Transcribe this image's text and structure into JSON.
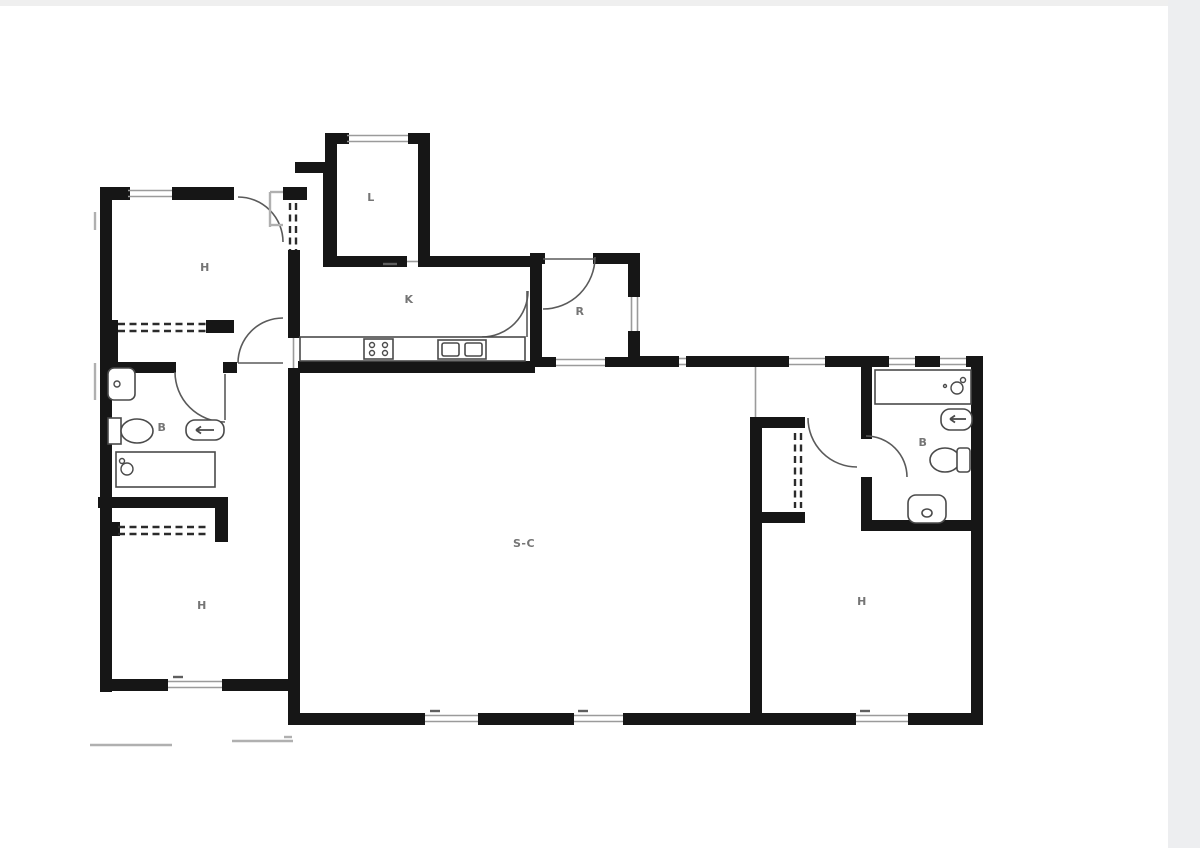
{
  "page": {
    "background": "#ffffff",
    "top_strip_color": "#efefef",
    "right_band_color": "#edeef0"
  },
  "plan": {
    "wall_color": "#161616",
    "window_color": "#9b9b9b",
    "door_color": "#5a5a5a",
    "dash_color": "#2b2b2b",
    "fixture_color": "#4a4a4a",
    "label_color": "#757575",
    "thin_color": "#b0b0b0",
    "tick_color": "#5f5f5f",
    "walls": [
      [
        100,
        187,
        30,
        13
      ],
      [
        172,
        187,
        62,
        13
      ],
      [
        283,
        187,
        24,
        13
      ],
      [
        100,
        187,
        12,
        505
      ],
      [
        106,
        320,
        12,
        45
      ],
      [
        206,
        320,
        28,
        13
      ],
      [
        288,
        250,
        12,
        88
      ],
      [
        288,
        368,
        12,
        357
      ],
      [
        325,
        133,
        12,
        42
      ],
      [
        295,
        162,
        42,
        11
      ],
      [
        323,
        173,
        14,
        94
      ],
      [
        325,
        133,
        24,
        11
      ],
      [
        408,
        133,
        22,
        11
      ],
      [
        418,
        133,
        12,
        134
      ],
      [
        337,
        256,
        70,
        11
      ],
      [
        430,
        256,
        105,
        11
      ],
      [
        530,
        253,
        12,
        114
      ],
      [
        535,
        253,
        10,
        11
      ],
      [
        593,
        253,
        47,
        11
      ],
      [
        628,
        253,
        12,
        44
      ],
      [
        628,
        331,
        12,
        36
      ],
      [
        530,
        357,
        26,
        10
      ],
      [
        605,
        357,
        35,
        10
      ],
      [
        298,
        361,
        237,
        12
      ],
      [
        640,
        356,
        39,
        11
      ],
      [
        686,
        356,
        69,
        11
      ],
      [
        755,
        356,
        34,
        11
      ],
      [
        825,
        356,
        38,
        11
      ],
      [
        863,
        356,
        26,
        11
      ],
      [
        915,
        356,
        25,
        11
      ],
      [
        966,
        356,
        17,
        11
      ],
      [
        971,
        356,
        12,
        368
      ],
      [
        750,
        417,
        12,
        308
      ],
      [
        750,
        417,
        55,
        11
      ],
      [
        758,
        512,
        47,
        11
      ],
      [
        861,
        367,
        11,
        72
      ],
      [
        861,
        477,
        11,
        54
      ],
      [
        861,
        520,
        122,
        11
      ],
      [
        750,
        713,
        106,
        12
      ],
      [
        908,
        713,
        75,
        12
      ],
      [
        288,
        713,
        137,
        12
      ],
      [
        478,
        713,
        96,
        12
      ],
      [
        623,
        713,
        127,
        12
      ],
      [
        100,
        362,
        76,
        11
      ],
      [
        223,
        362,
        14,
        11
      ],
      [
        98,
        497,
        130,
        11
      ],
      [
        215,
        497,
        13,
        45
      ],
      [
        112,
        522,
        8,
        14
      ],
      [
        100,
        679,
        68,
        12
      ],
      [
        222,
        679,
        78,
        12
      ]
    ],
    "windows": [
      {
        "o": "h",
        "x": 128,
        "y": 189,
        "len": 44
      },
      {
        "o": "h",
        "x": 347,
        "y": 134,
        "len": 61
      },
      {
        "o": "v",
        "x": 630,
        "y": 297,
        "len": 34
      },
      {
        "o": "h",
        "x": 556,
        "y": 358,
        "len": 49
      },
      {
        "o": "h",
        "x": 789,
        "y": 357,
        "len": 36
      },
      {
        "o": "h",
        "x": 889,
        "y": 357,
        "len": 26
      },
      {
        "o": "h",
        "x": 940,
        "y": 357,
        "len": 26
      },
      {
        "o": "h",
        "x": 425,
        "y": 714,
        "len": 53
      },
      {
        "o": "h",
        "x": 574,
        "y": 714,
        "len": 49
      },
      {
        "o": "h",
        "x": 856,
        "y": 714,
        "len": 52
      },
      {
        "o": "h",
        "x": 168,
        "y": 680,
        "len": 54
      },
      {
        "o": "h",
        "x": 679,
        "y": 357,
        "len": 7
      },
      {
        "o": "v",
        "x": 292,
        "y": 338,
        "len": 30,
        "single": true
      },
      {
        "o": "v",
        "x": 754,
        "y": 367,
        "len": 50,
        "single": true
      },
      {
        "o": "h",
        "x": 407,
        "y": 260,
        "len": 11,
        "single": true
      }
    ],
    "dashes": [
      [
        290,
        203,
        290,
        250
      ],
      [
        296,
        203,
        296,
        250
      ],
      [
        118,
        324,
        206,
        324
      ],
      [
        118,
        331,
        206,
        331
      ],
      [
        118,
        527,
        210,
        527
      ],
      [
        118,
        534,
        210,
        534
      ],
      [
        795,
        433,
        795,
        508
      ],
      [
        801,
        433,
        801,
        508
      ]
    ],
    "doors": [
      {
        "d": "M 238 197 A 45 45 0 0 1 283 242",
        "name": "door-swing-bedroom-topleft"
      },
      {
        "d": "M 238 363 A 45 45 0 0 1 283 318",
        "name": "door-swing-hall-living"
      },
      {
        "d": "M 175 372 A 50 50 0 0 0 225 422",
        "name": "door-swing-bath-left"
      },
      {
        "d": "M 528 291 A 46 46 0 0 1 482 337",
        "name": "door-swing-kitchen"
      },
      {
        "d": "M 595 257 A 52 52 0 0 1 543 309",
        "name": "door-swing-entrance"
      },
      {
        "d": "M 808 418 A 49 49 0 0 0 857 467",
        "name": "door-swing-bedroom-right"
      },
      {
        "d": "M 866 436 A 41 41 0 0 1 907 477",
        "name": "door-swing-bath-right"
      }
    ],
    "door_leaves": [
      [
        238,
        363,
        283,
        363
      ],
      [
        527,
        291,
        527,
        337
      ],
      [
        543,
        259,
        595,
        259
      ],
      [
        225,
        374,
        225,
        420
      ]
    ],
    "thin_lines": [
      [
        90,
        745,
        172,
        745
      ],
      [
        232,
        741,
        293,
        741
      ],
      [
        284,
        737,
        292,
        737
      ],
      [
        95,
        363,
        95,
        400
      ],
      [
        95,
        212,
        95,
        230
      ],
      [
        270,
        192,
        283,
        192
      ],
      [
        270,
        192,
        270,
        227
      ],
      [
        270,
        225,
        283,
        225
      ]
    ],
    "ticks": [
      [
        383,
        264,
        397,
        264
      ],
      [
        173,
        677,
        183,
        677
      ],
      [
        430,
        711,
        440,
        711
      ],
      [
        578,
        711,
        588,
        711
      ],
      [
        860,
        711,
        870,
        711
      ]
    ],
    "fixtures": [
      {
        "t": "rrect",
        "x": 108,
        "y": 368,
        "w": 27,
        "h": 32,
        "r": 6,
        "name": "bidet-left"
      },
      {
        "t": "circle",
        "cx": 117,
        "cy": 384,
        "r": 3,
        "name": "bidet-left-drain"
      },
      {
        "t": "rect",
        "x": 108,
        "y": 418,
        "w": 13,
        "h": 26,
        "name": "toilet-left-tank"
      },
      {
        "t": "ellipse",
        "cx": 137,
        "cy": 431,
        "rx": 16,
        "ry": 12,
        "name": "toilet-left-bowl"
      },
      {
        "t": "rrect",
        "x": 186,
        "y": 420,
        "w": 38,
        "h": 20,
        "r": 9,
        "name": "sink-left"
      },
      {
        "t": "arrow",
        "x1": 214,
        "y1": 430,
        "x2": 196,
        "y2": 430,
        "name": "sink-left-tap"
      },
      {
        "t": "rect",
        "x": 116,
        "y": 452,
        "w": 99,
        "h": 35,
        "name": "bathtub-left"
      },
      {
        "t": "circle",
        "cx": 127,
        "cy": 469,
        "r": 6,
        "name": "bathtub-left-faucet"
      },
      {
        "t": "circle",
        "cx": 122,
        "cy": 461,
        "r": 2.5,
        "name": "bathtub-left-tap"
      },
      {
        "t": "rect",
        "x": 875,
        "y": 370,
        "w": 96,
        "h": 34,
        "name": "bathtub-right"
      },
      {
        "t": "circle",
        "cx": 957,
        "cy": 388,
        "r": 6,
        "name": "bathtub-right-faucet"
      },
      {
        "t": "circle",
        "cx": 963,
        "cy": 380,
        "r": 2.5,
        "name": "bathtub-right-tap"
      },
      {
        "t": "circle",
        "cx": 945,
        "cy": 386,
        "r": 1.5,
        "name": "bathtub-right-dot"
      },
      {
        "t": "rrect",
        "x": 941,
        "y": 409,
        "w": 31,
        "h": 21,
        "r": 9,
        "name": "sink-right"
      },
      {
        "t": "arrow",
        "x1": 966,
        "y1": 419,
        "x2": 950,
        "y2": 419,
        "name": "sink-right-tap"
      },
      {
        "t": "ellipse",
        "cx": 945,
        "cy": 460,
        "rx": 15,
        "ry": 12,
        "name": "toilet-right-bowl"
      },
      {
        "t": "rrect",
        "x": 957,
        "y": 448,
        "w": 13,
        "h": 24,
        "r": 3,
        "name": "toilet-right-tank"
      },
      {
        "t": "rrect",
        "x": 908,
        "y": 495,
        "w": 38,
        "h": 28,
        "r": 8,
        "name": "bidet-right"
      },
      {
        "t": "ellipse",
        "cx": 927,
        "cy": 513,
        "rx": 5,
        "ry": 4,
        "name": "bidet-right-drain"
      },
      {
        "t": "rect",
        "x": 300,
        "y": 337,
        "w": 225,
        "h": 24,
        "name": "kitchen-counter"
      },
      {
        "t": "rect",
        "x": 364,
        "y": 339,
        "w": 29,
        "h": 20,
        "name": "stove"
      },
      {
        "t": "circle",
        "cx": 372,
        "cy": 345,
        "r": 2.5,
        "name": "stove-burner"
      },
      {
        "t": "circle",
        "cx": 385,
        "cy": 345,
        "r": 2.5,
        "name": "stove-burner"
      },
      {
        "t": "circle",
        "cx": 372,
        "cy": 353,
        "r": 2.5,
        "name": "stove-burner"
      },
      {
        "t": "circle",
        "cx": 385,
        "cy": 353,
        "r": 2.5,
        "name": "stove-burner"
      },
      {
        "t": "rect",
        "x": 438,
        "y": 340,
        "w": 48,
        "h": 19,
        "name": "kitchen-sink"
      },
      {
        "t": "rrect",
        "x": 442,
        "y": 343,
        "w": 17,
        "h": 13,
        "r": 2,
        "name": "kitchen-sink-basin"
      },
      {
        "t": "rrect",
        "x": 465,
        "y": 343,
        "w": 17,
        "h": 13,
        "r": 2,
        "name": "kitchen-sink-basin"
      }
    ],
    "labels": [
      {
        "text": "H",
        "x": 205,
        "y": 271,
        "name": "room-label-bedroom-topleft"
      },
      {
        "text": "L",
        "x": 371,
        "y": 201,
        "name": "room-label-laundry"
      },
      {
        "text": "K",
        "x": 409,
        "y": 303,
        "name": "room-label-kitchen"
      },
      {
        "text": "R",
        "x": 580,
        "y": 315,
        "name": "room-label-entry"
      },
      {
        "text": "B",
        "x": 162,
        "y": 431,
        "name": "room-label-bath-left"
      },
      {
        "text": "S-C",
        "x": 524,
        "y": 547,
        "name": "room-label-living-dining"
      },
      {
        "text": "H",
        "x": 202,
        "y": 609,
        "name": "room-label-bedroom-bottomleft"
      },
      {
        "text": "B",
        "x": 923,
        "y": 446,
        "name": "room-label-bath-right"
      },
      {
        "text": "H",
        "x": 862,
        "y": 605,
        "name": "room-label-bedroom-right"
      }
    ]
  }
}
